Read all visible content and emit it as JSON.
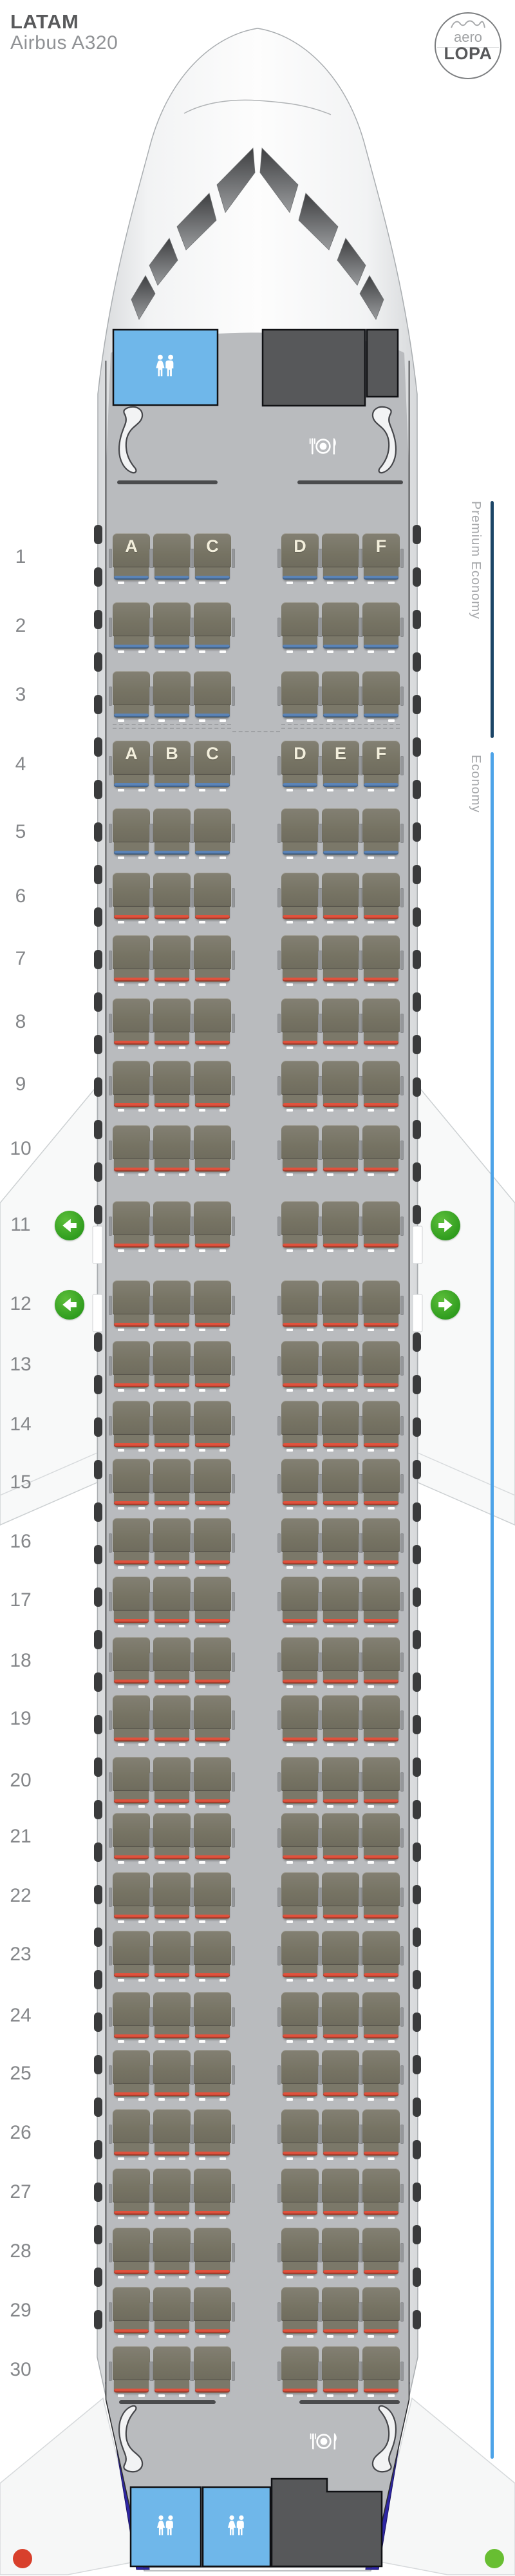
{
  "header": {
    "airline": "LATAM",
    "aircraft": "Airbus A320"
  },
  "logo": {
    "top": "aero",
    "bottom": "LOPA"
  },
  "classes": {
    "premium": {
      "label": "Premium Economy",
      "line_color": "#1c4566",
      "row_start": 1,
      "row_end": 3
    },
    "economy": {
      "label": "Economy",
      "line_color": "#4da3e8",
      "row_start": 4,
      "row_end": 30
    }
  },
  "colors": {
    "stripe_blue": "#5b84b8",
    "stripe_red": "#e0523d",
    "exit_green": "#37a525",
    "lavatory_blue": "#6fb7ea",
    "galley_gray": "#57585a",
    "tail_navy": "#2e26a3"
  },
  "seat_map": {
    "columns_left": [
      "A",
      "B",
      "C"
    ],
    "columns_right": [
      "D",
      "E",
      "F"
    ],
    "rows": [
      {
        "row": 1,
        "cabin": "premium",
        "stripe": "blue",
        "exit": false,
        "labels": [
          "A",
          "",
          "C",
          "D",
          "",
          "F"
        ]
      },
      {
        "row": 2,
        "cabin": "premium",
        "stripe": "blue",
        "exit": false,
        "labels": [
          "",
          "",
          "",
          "",
          "",
          ""
        ]
      },
      {
        "row": 3,
        "cabin": "premium",
        "stripe": "blue",
        "exit": false,
        "labels": [
          "",
          "",
          "",
          "",
          "",
          ""
        ]
      },
      {
        "row": 4,
        "cabin": "economy",
        "stripe": "blue",
        "exit": false,
        "labels": [
          "A",
          "B",
          "C",
          "D",
          "E",
          "F"
        ]
      },
      {
        "row": 5,
        "cabin": "economy",
        "stripe": "blue",
        "exit": false,
        "labels": [
          "",
          "",
          "",
          "",
          "",
          ""
        ]
      },
      {
        "row": 6,
        "cabin": "economy",
        "stripe": "red",
        "exit": false,
        "labels": [
          "",
          "",
          "",
          "",
          "",
          ""
        ]
      },
      {
        "row": 7,
        "cabin": "economy",
        "stripe": "red",
        "exit": false,
        "labels": [
          "",
          "",
          "",
          "",
          "",
          ""
        ]
      },
      {
        "row": 8,
        "cabin": "economy",
        "stripe": "red",
        "exit": false,
        "labels": [
          "",
          "",
          "",
          "",
          "",
          ""
        ]
      },
      {
        "row": 9,
        "cabin": "economy",
        "stripe": "red",
        "exit": false,
        "labels": [
          "",
          "",
          "",
          "",
          "",
          ""
        ]
      },
      {
        "row": 10,
        "cabin": "economy",
        "stripe": "red",
        "exit": false,
        "labels": [
          "",
          "",
          "",
          "",
          "",
          ""
        ]
      },
      {
        "row": 11,
        "cabin": "economy",
        "stripe": "red",
        "exit": true,
        "labels": [
          "",
          "",
          "",
          "",
          "",
          ""
        ]
      },
      {
        "row": 12,
        "cabin": "economy",
        "stripe": "red",
        "exit": true,
        "labels": [
          "",
          "",
          "",
          "",
          "",
          ""
        ]
      },
      {
        "row": 13,
        "cabin": "economy",
        "stripe": "red",
        "exit": false,
        "labels": [
          "",
          "",
          "",
          "",
          "",
          ""
        ]
      },
      {
        "row": 14,
        "cabin": "economy",
        "stripe": "red",
        "exit": false,
        "labels": [
          "",
          "",
          "",
          "",
          "",
          ""
        ]
      },
      {
        "row": 15,
        "cabin": "economy",
        "stripe": "red",
        "exit": false,
        "labels": [
          "",
          "",
          "",
          "",
          "",
          ""
        ]
      },
      {
        "row": 16,
        "cabin": "economy",
        "stripe": "red",
        "exit": false,
        "labels": [
          "",
          "",
          "",
          "",
          "",
          ""
        ]
      },
      {
        "row": 17,
        "cabin": "economy",
        "stripe": "red",
        "exit": false,
        "labels": [
          "",
          "",
          "",
          "",
          "",
          ""
        ]
      },
      {
        "row": 18,
        "cabin": "economy",
        "stripe": "red",
        "exit": false,
        "labels": [
          "",
          "",
          "",
          "",
          "",
          ""
        ]
      },
      {
        "row": 19,
        "cabin": "economy",
        "stripe": "red",
        "exit": false,
        "labels": [
          "",
          "",
          "",
          "",
          "",
          ""
        ]
      },
      {
        "row": 20,
        "cabin": "economy",
        "stripe": "red",
        "exit": false,
        "labels": [
          "",
          "",
          "",
          "",
          "",
          ""
        ]
      },
      {
        "row": 21,
        "cabin": "economy",
        "stripe": "red",
        "exit": false,
        "labels": [
          "",
          "",
          "",
          "",
          "",
          ""
        ]
      },
      {
        "row": 22,
        "cabin": "economy",
        "stripe": "red",
        "exit": false,
        "labels": [
          "",
          "",
          "",
          "",
          "",
          ""
        ]
      },
      {
        "row": 23,
        "cabin": "economy",
        "stripe": "red",
        "exit": false,
        "labels": [
          "",
          "",
          "",
          "",
          "",
          ""
        ]
      },
      {
        "row": 24,
        "cabin": "economy",
        "stripe": "red",
        "exit": false,
        "labels": [
          "",
          "",
          "",
          "",
          "",
          ""
        ]
      },
      {
        "row": 25,
        "cabin": "economy",
        "stripe": "red",
        "exit": false,
        "labels": [
          "",
          "",
          "",
          "",
          "",
          ""
        ]
      },
      {
        "row": 26,
        "cabin": "economy",
        "stripe": "red",
        "exit": false,
        "labels": [
          "",
          "",
          "",
          "",
          "",
          ""
        ]
      },
      {
        "row": 27,
        "cabin": "economy",
        "stripe": "red",
        "exit": false,
        "labels": [
          "",
          "",
          "",
          "",
          "",
          ""
        ]
      },
      {
        "row": 28,
        "cabin": "economy",
        "stripe": "red",
        "exit": false,
        "labels": [
          "",
          "",
          "",
          "",
          "",
          ""
        ]
      },
      {
        "row": 29,
        "cabin": "economy",
        "stripe": "red",
        "exit": false,
        "labels": [
          "",
          "",
          "",
          "",
          "",
          ""
        ]
      },
      {
        "row": 30,
        "cabin": "economy",
        "stripe": "red",
        "exit": false,
        "labels": [
          "",
          "",
          "",
          "",
          "",
          ""
        ]
      }
    ]
  },
  "facilities": {
    "front": [
      "lavatory",
      "galley"
    ],
    "rear": [
      "lavatory",
      "lavatory",
      "galley"
    ]
  },
  "status_dots": {
    "left_color": "#d8402c",
    "right_color": "#68be32"
  }
}
